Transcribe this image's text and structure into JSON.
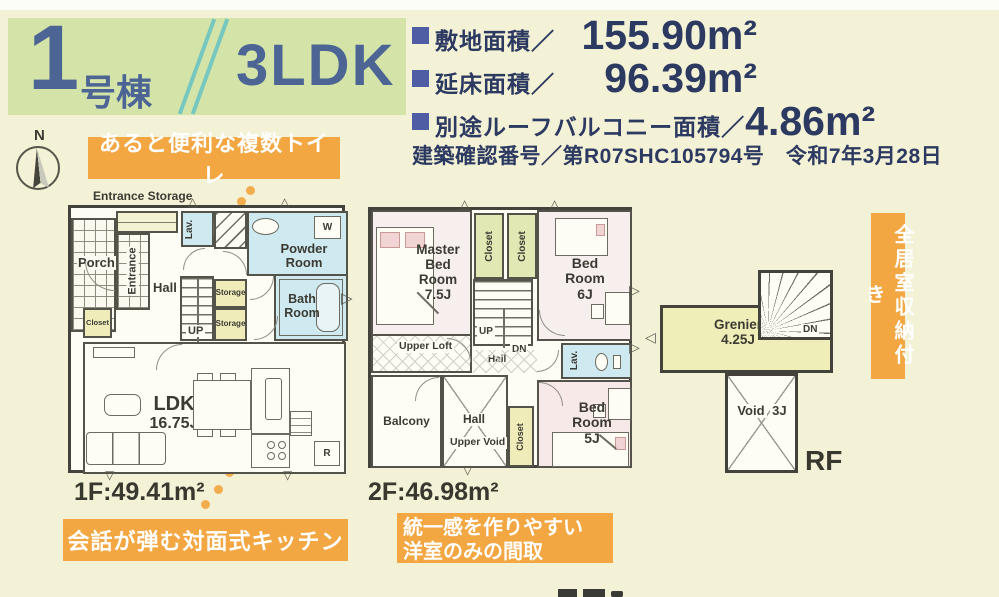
{
  "title": {
    "number": "1",
    "suffix": "号棟",
    "plan_type": "3LDK"
  },
  "specs": {
    "site": {
      "label": "敷地面積／",
      "value": "155.90",
      "unit": "m²"
    },
    "floor": {
      "label": "延床面積／",
      "value": "96.39",
      "unit": "m²"
    },
    "roof": {
      "label": "別途ルーフバルコニー面積／",
      "value": "4.86",
      "unit": "m²"
    },
    "confirmation": "建築確認番号／第R07SHC105794号　令和7年3月28日"
  },
  "compass": {
    "north": "N"
  },
  "banners": {
    "toilet": "あると便利な複数トイレ",
    "kitchen": "会話が弾む対面式キッチン",
    "western1": "統一感を作りやすい",
    "western2": "洋室のみの間取",
    "storage": "全居室収納付き"
  },
  "floor1": {
    "area": "1F:49.41m²",
    "entrance_storage": "Entrance Storage",
    "porch": "Porch",
    "entrance": "Entrance",
    "hall": "Hall",
    "lav": "Lav.",
    "powder": "Powder Room",
    "bath": "Bath Room",
    "storage1": "Storage",
    "storage2": "Storage",
    "closet": "Closet",
    "up": "UP",
    "ldk_name": "LDK",
    "ldk_size": "16.75J",
    "washer": "W",
    "fridge": "R"
  },
  "floor2": {
    "area": "2F:46.98m²",
    "master_name": "Master Bed Room",
    "master_size": "7.5J",
    "closet1": "Closet",
    "closet2": "Closet",
    "bed6_name": "Bed Room",
    "bed6_size": "6J",
    "upper_loft": "Upper Loft",
    "up": "UP",
    "dn": "DN",
    "hall_small": "Hall",
    "lav": "Lav.",
    "balcony": "Balcony",
    "hall": "Hall",
    "upper_void": "Upper Void",
    "closet3": "Closet",
    "bed5_name": "Bed Room",
    "bed5_size": "5J"
  },
  "roof_floor": {
    "label": "RF",
    "grenier_name": "Grenier",
    "grenier_size": "4.25J",
    "void_name": "Void",
    "void_size": "3J",
    "dn": "DN"
  }
}
